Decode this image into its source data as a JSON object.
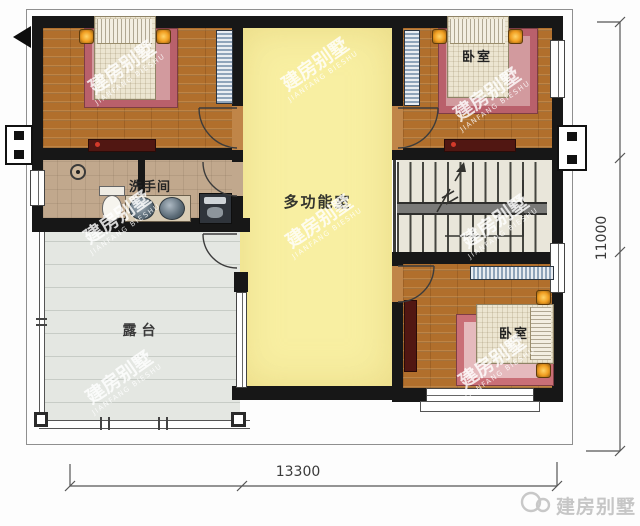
{
  "plan": {
    "title": "villa-second-floor-plan",
    "rooms": {
      "multi_function": "多功能室",
      "bathroom": "洗手间",
      "terrace": "露台",
      "bedroom_top_right": "卧室",
      "bedroom_bottom_right": "卧室"
    },
    "dimensions": {
      "bottom_width": "13300",
      "right_height": "11000"
    }
  },
  "watermark": {
    "line1": "建房别墅",
    "line2": "JIANFANG BIESHU"
  },
  "logo": {
    "text": "建房别墅",
    "icon": "double-circle-icon"
  },
  "colors": {
    "wall": "#171717",
    "wood_floor": "#b16f2c",
    "multi_function_fill": "#f8efa2",
    "bathroom_fill": "#c1a88d",
    "terrace_fill": "#e4e7e2",
    "stairs_fill": "#e9e6da",
    "rug_outer": "#b9606b",
    "rug_inner": "#d29a9e",
    "lamp_glow": "#f09d20",
    "logo_gray": "#c6c6c6"
  }
}
